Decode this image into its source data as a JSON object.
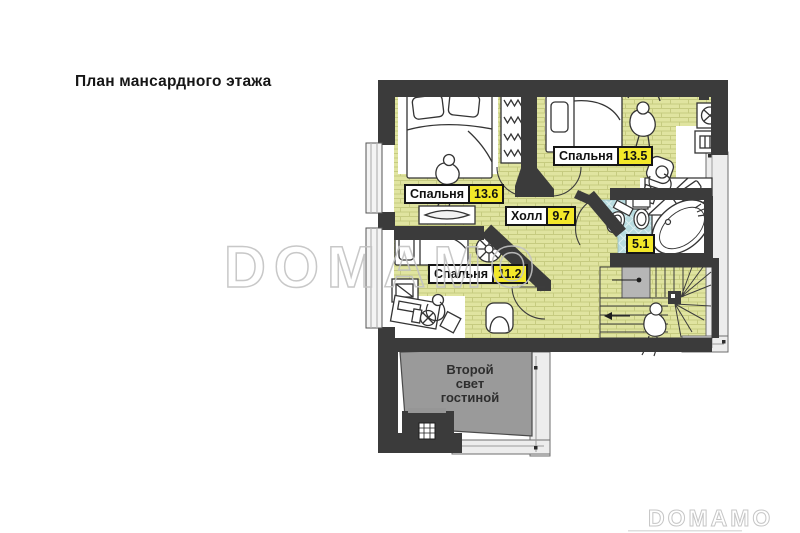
{
  "title": "План мансардного этажа",
  "watermark": {
    "center": "DOMAMO",
    "corner": "DOMAMO"
  },
  "plan": {
    "type": "floor-plan",
    "labels": {
      "bedroom_tl": {
        "name": "Спальня",
        "area": "13.6"
      },
      "bedroom_tr": {
        "name": "Спальня",
        "area": "13.5"
      },
      "bedroom_bl": {
        "name": "Спальня",
        "area": "11.2"
      },
      "hall": {
        "name": "Холл",
        "area": "9.7"
      },
      "bathroom": {
        "area": "5.1"
      },
      "void": {
        "lines": [
          "Второй",
          "свет",
          "гостиной"
        ]
      }
    },
    "colors": {
      "floor": "#e0e4a0",
      "floor_joint": "#c6cb80",
      "wall": "#3b3b3b",
      "bath_tile": "#b8dce0",
      "void_gray": "#9a9a9a",
      "landing_gray": "#b6b6b6",
      "terrace": "#ededed",
      "label_value_bg": "#f3e829",
      "watermark_gray": "#c3c3c3"
    }
  }
}
